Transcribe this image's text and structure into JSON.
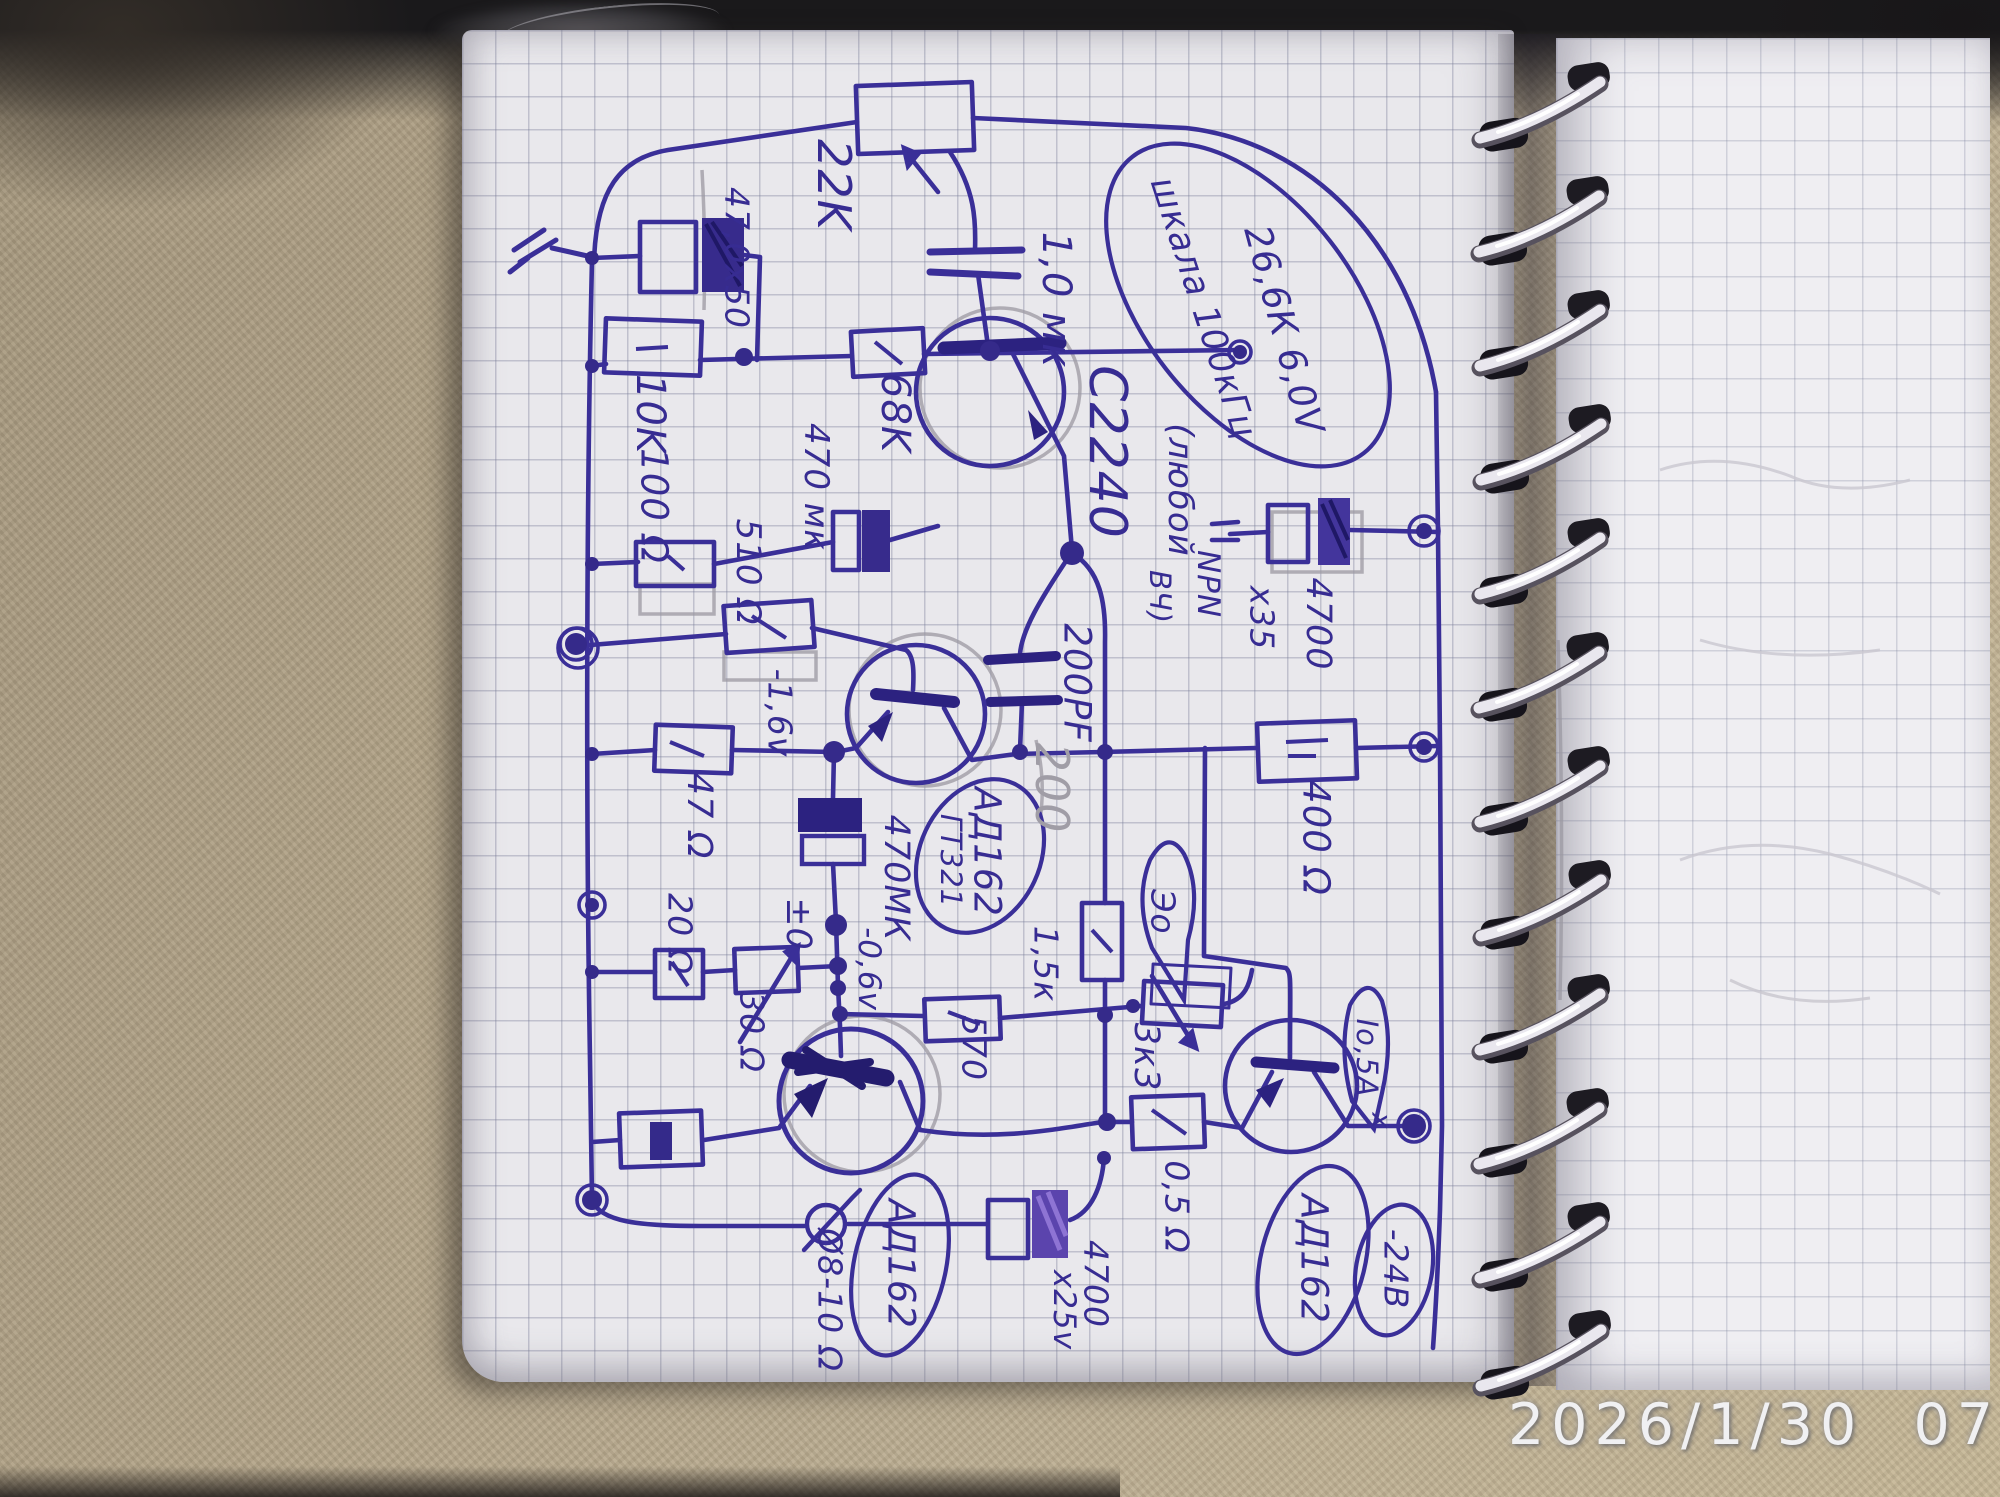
{
  "photo": {
    "timestamp": "2026/1/30  07:47"
  },
  "labels": {
    "r22k": "22K",
    "c47": "47,0х50",
    "r10k": "10K",
    "r100": "100 Ω",
    "r68k": "68K",
    "c470mk": "470 мк",
    "r510": "510 Ω",
    "c1mk": "1,0 мк",
    "q1": "C2240",
    "q1_note_1": "(любой",
    "q1_note_2": "NPN",
    "q1_note_3": "ВЧ)",
    "note_1": "26,6К 6,0V",
    "note_2": "шкала 100кГц",
    "c4700_35": "4700",
    "c4700_35_v": "х35",
    "c200pf": "200PF",
    "c200_pencil": "200",
    "q2_1": "АД162",
    "q2_2": "ГТ321",
    "c470mk_big": "470МК",
    "v_m1_6": "-1,6v",
    "v_m0_6": "-0,6v",
    "v_pm0": "±0",
    "r47": "47 Ω",
    "r20": "20 Ω",
    "r30": "30 Ω",
    "r1k5": "1,5к",
    "r570": "570",
    "r3k3": "3к3",
    "eo": "Эо",
    "r400": "400 Ω",
    "i05": "Iо,5А",
    "stray_x": "х",
    "v_m24": "-24В",
    "q3": "АД162",
    "q4": "АД162",
    "spk": "Ø8-10 Ω",
    "c4700_25": "4700",
    "c4700_25_v": "х25v",
    "r0_5": "0,5 Ω"
  }
}
